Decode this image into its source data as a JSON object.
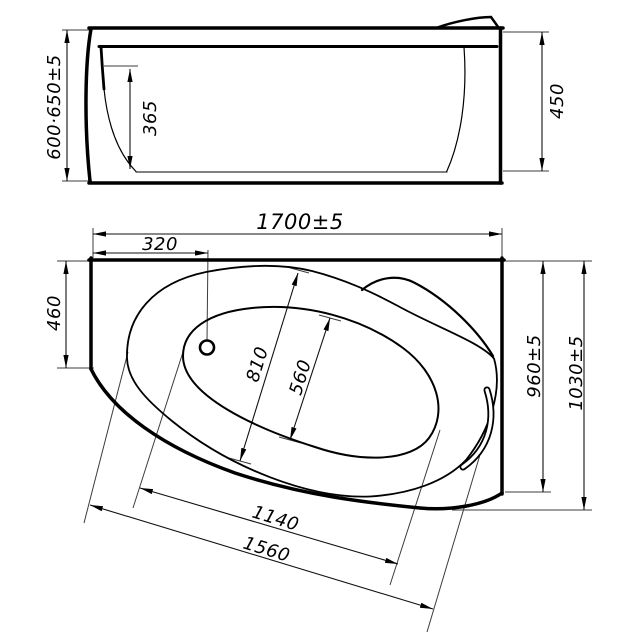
{
  "drawing": {
    "type": "bathtub-technical-drawing",
    "background": "#ffffff",
    "line_color": "#000000",
    "side_view": {
      "dims": {
        "height_range": "600·650±5",
        "inner_depth": "365",
        "shell_height": "450"
      }
    },
    "plan_view": {
      "dims": {
        "overall_length": "1700±5",
        "drain_offset": "320",
        "corner_side": "460",
        "rim_opening_width": "810",
        "basin_width": "560",
        "side_width": "960±5",
        "overall_width": "1030±5",
        "basin_length": "1140",
        "front_edge_length": "1560"
      }
    }
  }
}
